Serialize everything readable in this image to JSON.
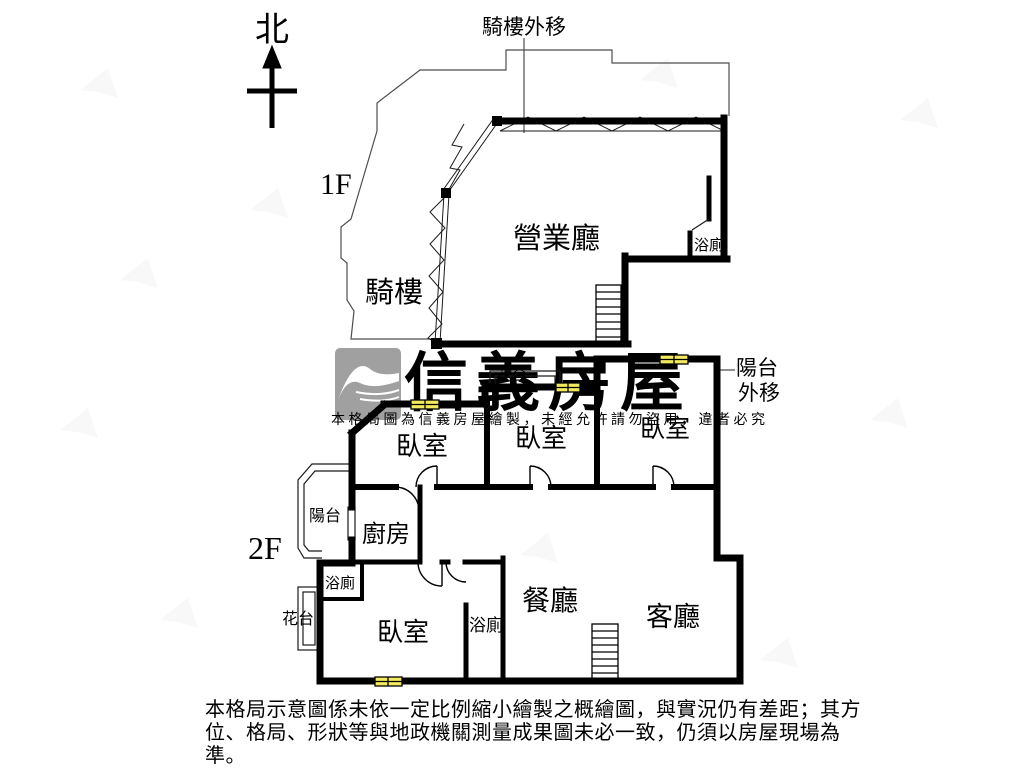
{
  "north": {
    "label": "北"
  },
  "floor1": {
    "label": "1F",
    "annotation_top": "騎樓外移",
    "rooms": {
      "hall": "營業廳",
      "arcade": "騎樓",
      "bath": "浴廁"
    }
  },
  "floor2": {
    "label": "2F",
    "annotation_right": {
      "line1": "陽台",
      "line2": "外移"
    },
    "rooms": {
      "bedroom1": "臥室",
      "bedroom2": "臥室",
      "bedroom3": "臥室",
      "bedroom4": "臥室",
      "balcony": "陽台",
      "kitchen": "廚房",
      "bath_upper": "浴廁",
      "bath_center": "浴廁",
      "flower_left": "花台",
      "flower_top": "花台",
      "dining": "餐廳",
      "living": "客廳"
    }
  },
  "watermark": {
    "brand": "信義房屋",
    "notice": "本格局圖為信義房屋繪製，未經允許請勿盜用，違者必究"
  },
  "disclaimer": {
    "line1": "本格局示意圖係未依一定比例縮小繪製之概繪圖，與實況仍有差距；其方",
    "line2": "位、格局、形狀等與地政機關測量成果圖未必一致，仍須以房屋現場為準。",
    "line3": "本圖為信義房屋繪製，盜用必究。"
  },
  "colors": {
    "wall": "#000000",
    "window_fill": "#f2e95e",
    "watermark_gray": "#9c9c9c",
    "logo_gray": "#a0a0a0",
    "notice_gray": "#b5b5b5",
    "boundary_gray": "#4d4d4d"
  }
}
